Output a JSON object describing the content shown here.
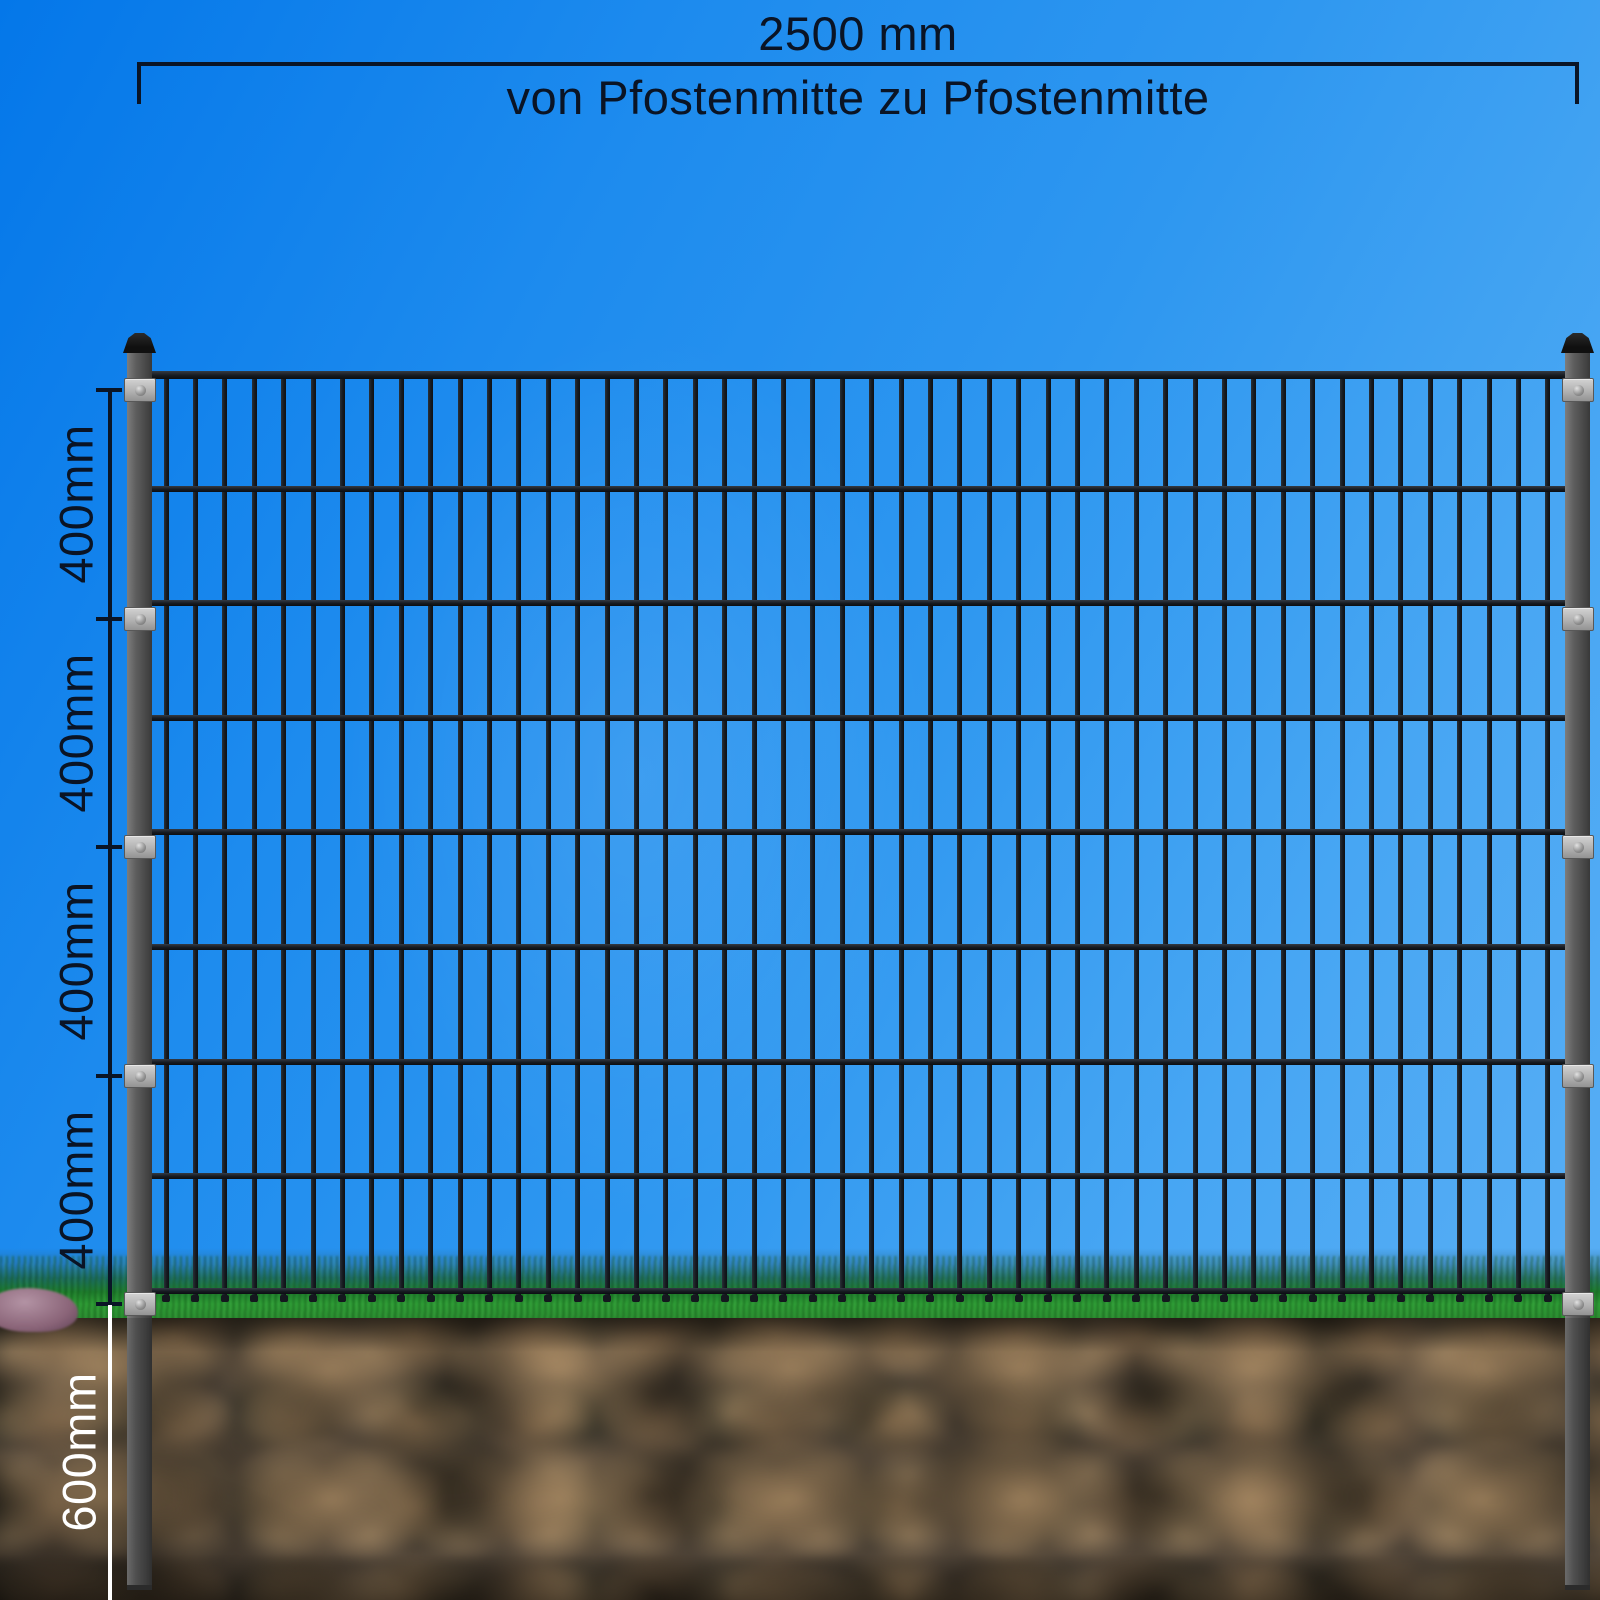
{
  "scene": {
    "description": "Doppelstabmatten-Zaunfeld zwischen zwei Pfosten mit Bemassung",
    "sky_color_top_left": "#0477e9",
    "sky_color_bottom_right": "#58aef4",
    "grass_color": "#2e9e35",
    "soil_base_color": "#4e4337",
    "rock_color": "#8a6478"
  },
  "fence": {
    "bar_color": "#14181e",
    "post_color": "#5e5e5e",
    "post_cap_color": "#141414",
    "clamp_color": "#b2b2b2",
    "panel": {
      "vertical_bars": 48,
      "horizontal_rails": 9
    },
    "posts": {
      "count": 2,
      "clamps_per_post": 5
    }
  },
  "dimensions": {
    "line_color": "#0a1526",
    "underground_line_color": "#ffffff",
    "top": {
      "label": "2500 mm",
      "subtitle": "von Pfostenmitte zu Pfostenmitte"
    },
    "left_segments": [
      {
        "label": "400mm"
      },
      {
        "label": "400mm"
      },
      {
        "label": "400mm"
      },
      {
        "label": "400mm"
      }
    ],
    "underground": {
      "label": "600mm"
    }
  }
}
